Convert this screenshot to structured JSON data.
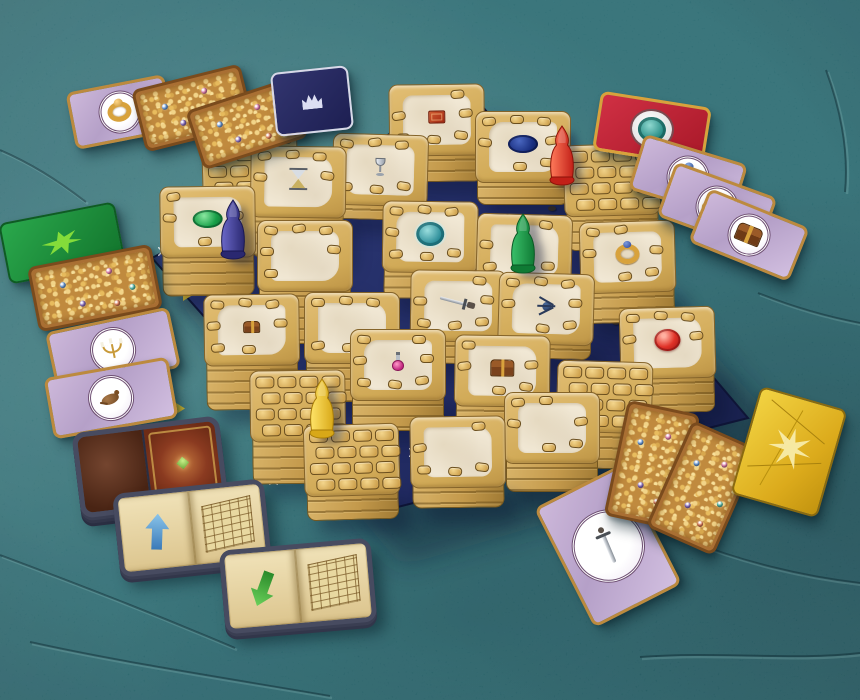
{
  "scene": {
    "subject": "labyrinth-board-game-photo",
    "palette": {
      "table_teal": "#2e8089",
      "board_navy_light": "#33407e",
      "board_navy_dark": "#1a2250",
      "tile_gold": "#d0a956",
      "tile_cream": "#f2e9d6",
      "shadow": "#0a1c30"
    }
  },
  "table": {
    "cracks": [
      "M0,555 C80,585 150,612 235,648",
      "M30,642 C120,662 225,678 330,696",
      "M640,657 C720,651 792,661 860,653",
      "M758,293 C800,310 834,318 860,323",
      "M688,540 C740,561 800,576 860,583",
      "M0,150 C30,163 56,179 86,202",
      "M826,70 C840,108 849,150 845,192"
    ]
  },
  "board": {
    "base_points": "470,92 748,418 378,512 152,258",
    "shadow_points": "500,120 800,448 402,566 170,292",
    "star_marks": [
      [
        162,
        251
      ],
      [
        212,
        357
      ],
      [
        273,
        480
      ],
      [
        340,
        498
      ],
      [
        413,
        452
      ],
      [
        695,
        400
      ],
      [
        628,
        448
      ]
    ],
    "corner_triangles": [
      [
        183,
        293
      ],
      [
        173,
        408
      ],
      [
        445,
        494
      ]
    ],
    "rubble": [
      [
        527,
        168
      ],
      [
        548,
        206
      ],
      [
        470,
        251
      ],
      [
        584,
        240
      ],
      [
        612,
        320
      ],
      [
        436,
        418
      ]
    ],
    "tile_w": 96,
    "tile_h": 72,
    "tiles": [
      {
        "cx": 250,
        "cy": 163,
        "stack": 16,
        "icon": null,
        "style": "brick"
      },
      {
        "cx": 437,
        "cy": 120,
        "stack": 26,
        "icon": "red_book",
        "style": "plaster"
      },
      {
        "cx": 523,
        "cy": 147,
        "stack": 22,
        "icon": "blue_gem",
        "style": "plaster"
      },
      {
        "cx": 298,
        "cy": 182,
        "stack": 40,
        "icon": "hourglass",
        "style": "plaster"
      },
      {
        "cx": 380,
        "cy": 170,
        "stack": 14,
        "icon": "goblet",
        "style": "plaster"
      },
      {
        "cx": 612,
        "cy": 180,
        "stack": 34,
        "icon": null,
        "style": "brick"
      },
      {
        "cx": 208,
        "cy": 222,
        "stack": 38,
        "icon": "green_gem",
        "style": "plaster"
      },
      {
        "cx": 305,
        "cy": 256,
        "stack": 52,
        "icon": null,
        "style": "plaster"
      },
      {
        "cx": 430,
        "cy": 237,
        "stack": 26,
        "icon": "teal_medallion",
        "style": "plaster"
      },
      {
        "cx": 524,
        "cy": 250,
        "stack": 18,
        "icon": null,
        "style": "plaster"
      },
      {
        "cx": 628,
        "cy": 257,
        "stack": 30,
        "icon": "gold_ring",
        "style": "plaster"
      },
      {
        "cx": 252,
        "cy": 330,
        "stack": 44,
        "icon": "chest_small",
        "style": "plaster"
      },
      {
        "cx": 352,
        "cy": 328,
        "stack": 38,
        "icon": null,
        "style": "plaster"
      },
      {
        "cx": 458,
        "cy": 306,
        "stack": 22,
        "icon": "sword",
        "style": "plaster"
      },
      {
        "cx": 546,
        "cy": 309,
        "stack": 14,
        "icon": "spider",
        "style": "plaster"
      },
      {
        "cx": 668,
        "cy": 343,
        "stack": 34,
        "icon": "red_gem",
        "style": "plaster"
      },
      {
        "cx": 298,
        "cy": 406,
        "stack": 42,
        "icon": null,
        "style": "brick"
      },
      {
        "cx": 398,
        "cy": 365,
        "stack": 30,
        "icon": "potion",
        "style": "plaster"
      },
      {
        "cx": 502,
        "cy": 371,
        "stack": 40,
        "icon": "chest",
        "style": "plaster"
      },
      {
        "cx": 604,
        "cy": 397,
        "stack": 36,
        "icon": null,
        "style": "brick"
      },
      {
        "cx": 352,
        "cy": 460,
        "stack": 24,
        "icon": null,
        "style": "brick"
      },
      {
        "cx": 458,
        "cy": 452,
        "stack": 20,
        "icon": null,
        "style": "plaster"
      },
      {
        "cx": 552,
        "cy": 428,
        "stack": 28,
        "icon": null,
        "style": "plaster"
      }
    ]
  },
  "pawns": [
    {
      "name": "red",
      "x": 562,
      "y": 182,
      "light": "#ff7a5a",
      "dark": "#c22018",
      "stroke": "#8a1208"
    },
    {
      "name": "blue",
      "x": 233,
      "y": 256,
      "light": "#6a68c8",
      "dark": "#2a2870",
      "stroke": "#1a1850"
    },
    {
      "name": "green",
      "x": 523,
      "y": 270,
      "light": "#3ac06a",
      "dark": "#0f7a34",
      "stroke": "#0a5824"
    },
    {
      "name": "yellow",
      "x": 322,
      "y": 435,
      "light": "#ffe468",
      "dark": "#d8a818",
      "stroke": "#a87c08"
    }
  ],
  "cards": [
    {
      "name": "treasure-card-gold-ring",
      "type": "treasure",
      "icon": "gold_ring",
      "cx": 120,
      "cy": 112,
      "w": 100,
      "h": 58,
      "rot": -11
    },
    {
      "name": "gold-pile-card",
      "type": "gold_pile",
      "cx": 193,
      "cy": 108,
      "w": 112,
      "h": 64,
      "rot": -14
    },
    {
      "name": "gold-pile-card",
      "type": "gold_pile",
      "cx": 247,
      "cy": 124,
      "w": 110,
      "h": 62,
      "rot": -18
    },
    {
      "name": "navy-card-back",
      "type": "back_navy",
      "cx": 312,
      "cy": 101,
      "w": 78,
      "h": 64,
      "rot": -6
    },
    {
      "name": "red-card-back",
      "type": "back_red",
      "cx": 652,
      "cy": 129,
      "w": 112,
      "h": 60,
      "rot": 9
    },
    {
      "name": "treasure-card-ring-gem",
      "type": "treasure",
      "icon": "ring_gem",
      "cx": 688,
      "cy": 177,
      "w": 108,
      "h": 58,
      "rot": 17
    },
    {
      "name": "treasure-card-gold-key",
      "type": "treasure",
      "icon": "gold_key",
      "cx": 717,
      "cy": 207,
      "w": 108,
      "h": 58,
      "rot": 20
    },
    {
      "name": "treasure-card-chest",
      "type": "treasure",
      "icon": "chest",
      "cx": 749,
      "cy": 235,
      "w": 108,
      "h": 58,
      "rot": 22
    },
    {
      "name": "green-card-back",
      "type": "back_green",
      "cx": 62,
      "cy": 243,
      "w": 118,
      "h": 62,
      "rot": -11
    },
    {
      "name": "gold-pile-card",
      "type": "gold_pile",
      "cx": 95,
      "cy": 288,
      "w": 126,
      "h": 66,
      "rot": -11
    },
    {
      "name": "treasure-card-candelabra",
      "type": "treasure",
      "icon": "candelabra",
      "cx": 113,
      "cy": 350,
      "w": 126,
      "h": 62,
      "rot": -12
    },
    {
      "name": "treasure-card-rat",
      "type": "treasure",
      "icon": "rat",
      "cx": 111,
      "cy": 398,
      "w": 126,
      "h": 62,
      "rot": -10
    },
    {
      "name": "book-cover-tile-stack",
      "type": "book_cover",
      "cx": 150,
      "cy": 467,
      "w": 148,
      "h": 86,
      "rot": -7
    },
    {
      "name": "open-book-tile-blue-arrow",
      "type": "book_open",
      "arrow": "blue_up",
      "cx": 192,
      "cy": 528,
      "w": 152,
      "h": 84,
      "rot": -6
    },
    {
      "name": "open-book-tile-green-arrow",
      "type": "book_open",
      "arrow": "green_down",
      "cx": 298,
      "cy": 586,
      "w": 152,
      "h": 84,
      "rot": -5
    },
    {
      "name": "treasure-card-sword",
      "type": "treasure",
      "icon": "sword_v",
      "cx": 608,
      "cy": 546,
      "w": 98,
      "h": 134,
      "rot": -27
    },
    {
      "name": "gold-pile-card",
      "type": "gold_pile",
      "cx": 652,
      "cy": 465,
      "w": 74,
      "h": 118,
      "rot": 12
    },
    {
      "name": "gold-pile-card",
      "type": "gold_pile",
      "cx": 703,
      "cy": 488,
      "w": 74,
      "h": 116,
      "rot": 24
    },
    {
      "name": "golden-card",
      "type": "gold_yellow",
      "cx": 789,
      "cy": 452,
      "w": 90,
      "h": 112,
      "rot": 16
    }
  ]
}
